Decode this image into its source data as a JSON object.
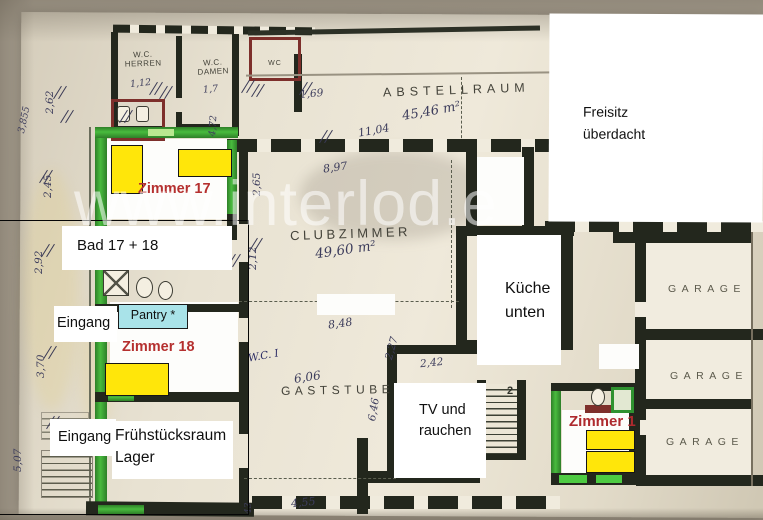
{
  "watermark": {
    "text": "www.interlod.e"
  },
  "plan_labels": {
    "wc_herren": "W.C.\nHERREN",
    "wc_damen": "W.C.\nDAMEN",
    "wc_small": "WC",
    "abstellraum": "ABSTELLRAUM",
    "clubzimmer": "CLUBZIMMER",
    "gaststube": "GASTSTUBE",
    "garage_1": "GARAGE",
    "garage_2": "GARAGE",
    "garage_3": "GARAGE",
    "stair_count": "2"
  },
  "overlays": {
    "freisitz": "Freisitz\nüberdacht",
    "bad": "Bad 17 + 18",
    "eingang_upper": "Eingang",
    "eingang_lower": "Eingang",
    "fruehstuecksraum": "Frühstücksraum\nLager",
    "kueche": "Küche\nunten",
    "tv": "TV und\nrauchen",
    "pantry": "Pantry *",
    "zimmer_17": "Zimmer 17",
    "zimmer_18": "Zimmer 18",
    "zimmer_1": "Zimmer 1"
  },
  "dimensions": {
    "left_1": "2,62",
    "left_2": "3,855",
    "left_3": "2,45",
    "left_4": "2,92",
    "left_5": "3,70",
    "left_6": "5,07",
    "wc_herren_w": "1,12",
    "wc_damen_w": "1,7",
    "corridor_w": "1,69",
    "wc_depth": "4,72",
    "abstell_len": "11,04",
    "abstell_area": "45,46 m²",
    "club_w_top": "8,97",
    "club_h": "2,65",
    "club_h2": "2,12",
    "club_area": "49,60 m²",
    "club_w_bottom": "8,48",
    "mid_1": "2,27",
    "mid_2": "2,42",
    "wc_blue": "W.C. I",
    "gast_w": "6,06",
    "gast_h": "6,46",
    "bottom_w": "4,55",
    "bottom_v": "43"
  },
  "colors": {
    "bed_highlight": "#ffe60a",
    "pantry_fill": "#a9e3e9",
    "wall_highlight_green": "#49bb3e",
    "wall_red": "#7d2f2b",
    "label_red": "#b5302f",
    "paper": "#e9e3d3",
    "photo_background": "#b3aa9b"
  }
}
